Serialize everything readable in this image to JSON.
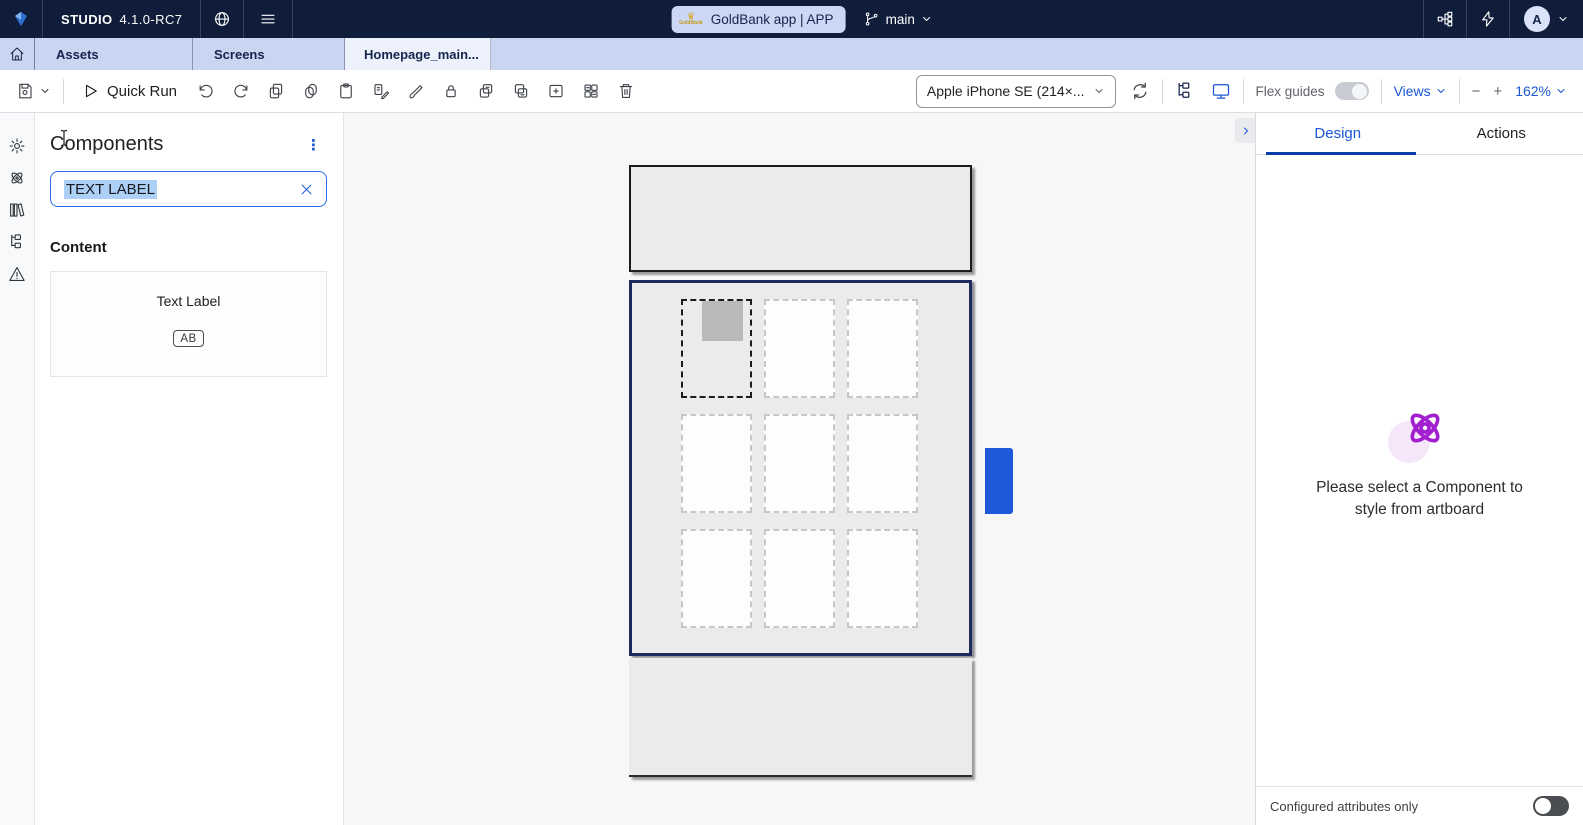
{
  "navbar": {
    "brand": "STUDIO",
    "version": "4.1.0-RC7",
    "app_pill": {
      "logo_label": "GoldBank",
      "label": "GoldBank app | APP"
    },
    "branch": {
      "name": "main"
    },
    "avatar_initial": "A"
  },
  "tabbar": {
    "tabs": [
      {
        "label": "Assets"
      },
      {
        "label": "Screens"
      }
    ],
    "active_tab": {
      "label": "Homepage_main..."
    }
  },
  "toolbar": {
    "quick_run_label": "Quick Run",
    "device_selector_value": "Apple iPhone SE (214×...",
    "flex_guides_label": "Flex guides",
    "views_label": "Views",
    "zoom_level": "162%"
  },
  "left_panel": {
    "title": "Components",
    "search": {
      "value": "TEXT LABEL"
    },
    "section_heading": "Content",
    "component_item": {
      "label": "Text Label",
      "icon_text": "AB"
    }
  },
  "canvas": {
    "artboard": {
      "grid_rows": 3,
      "grid_cols": 3,
      "selected_placeholder_index": 0
    }
  },
  "right_panel": {
    "tabs": {
      "design": "Design",
      "actions": "Actions"
    },
    "empty_state_text": "Please select a Component to style from artboard",
    "footer": {
      "label": "Configured attributes only"
    }
  },
  "icons": {
    "kebab": "⋮",
    "minus": "−",
    "plus": "+",
    "crown": "♛"
  },
  "colors": {
    "accent_blue": "#1a56d6",
    "navy": "#0f1d3a",
    "purple": "#a21fd0",
    "selection_border": "#1e2a5e",
    "handle_blue": "#1d59d8"
  }
}
